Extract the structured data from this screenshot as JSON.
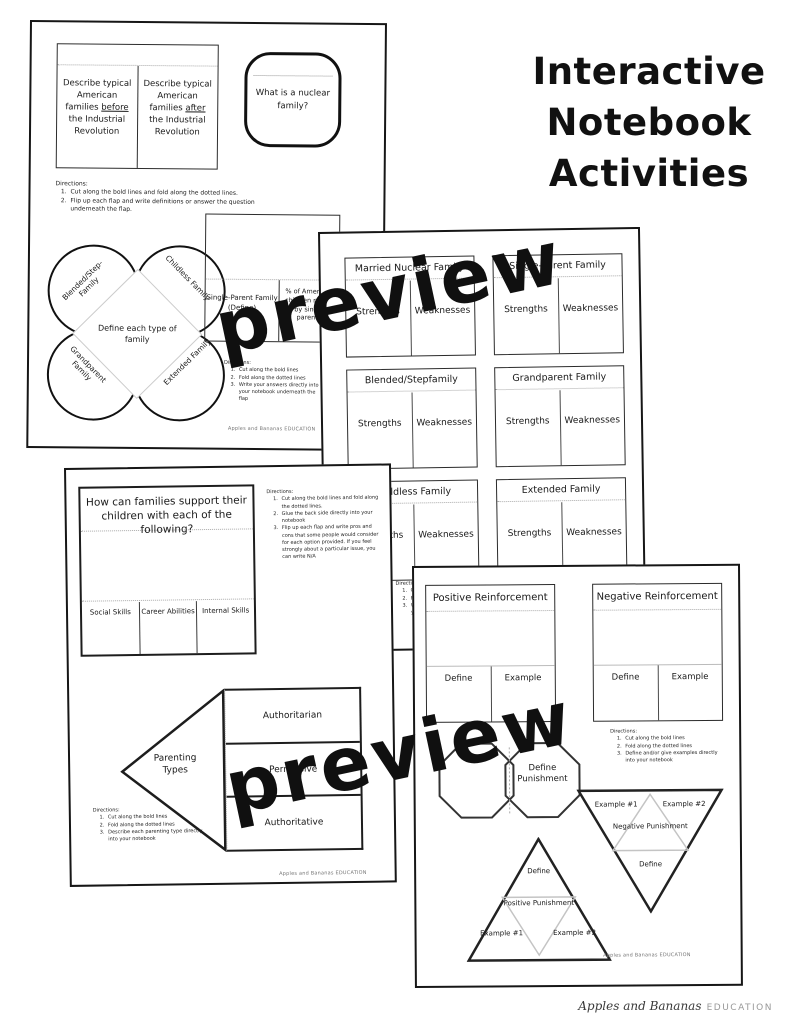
{
  "title": {
    "line1": "Interactive",
    "line2": "Notebook",
    "line3": "Activities"
  },
  "watermark": "preview",
  "brand": {
    "script": "Apples and Bananas",
    "caps": "EDUCATION"
  },
  "page_footer": "Apples and Bananas EDUCATION",
  "colors": {
    "ink": "#111111",
    "fold_dotted": "#aaaaaa",
    "light_gray": "#cccccc"
  },
  "page1": {
    "flap_left": {
      "pre": "Describe typical American families ",
      "u": "before",
      "post": " the Industrial Revolution"
    },
    "flap_right": {
      "pre": "Describe typical American families ",
      "u": "after",
      "post": " the Industrial Revolution"
    },
    "nuclear_question": "What is a nuclear family?",
    "directions_top": {
      "heading": "Directions:",
      "items": [
        "Cut along the bold lines and fold along the dotted lines.",
        "Flip up each flap and write definitions or answer the question underneath the flap."
      ]
    },
    "petals": {
      "top_left": "Blended/Step-Family",
      "top_right": "Childless Family",
      "bottom_left": "Grandparent Family",
      "bottom_right": "Extended Family",
      "center": "Define each type of family"
    },
    "single_parent_label": "Single-Parent Family (Define)",
    "percent_label": "% of American children raised by single parents",
    "directions_bottom": {
      "heading": "Directions:",
      "items": [
        "Cut along the bold lines",
        "Fold along the dotted lines",
        "Write your answers directly into your notebook underneath the flap"
      ]
    }
  },
  "page2": {
    "cards": [
      {
        "title": "Married Nuclear Family",
        "left": "Strengths",
        "right": "Weaknesses"
      },
      {
        "title": "Single-Parent Family",
        "left": "Strengths",
        "right": "Weaknesses"
      },
      {
        "title": "Blended/Stepfamily",
        "left": "Strengths",
        "right": "Weaknesses"
      },
      {
        "title": "Grandparent Family",
        "left": "Strengths",
        "right": "Weaknesses"
      },
      {
        "title": "Childless Family",
        "left": "Strengths",
        "right": "Weaknesses"
      },
      {
        "title": "Extended Family",
        "left": "Strengths",
        "right": "Weaknesses"
      }
    ],
    "directions": {
      "heading": "Directions:",
      "items": [
        "Cut along the bold lines",
        "Fold along the dotted lines",
        "Write your answers directly into your notebook"
      ]
    }
  },
  "page3": {
    "support_title": "How can families support their children with each of the following?",
    "columns": [
      "Social Skills",
      "Career Abilities",
      "Internal Skills"
    ],
    "directions_top": {
      "heading": "Directions:",
      "items": [
        "Cut along the bold lines and fold along the dotted lines.",
        "Glue the back side directly into your notebook",
        "Flip up each flap and write pros and cons that some people would consider for each option provided. If you feel strongly about a particular issue, you can write N/A"
      ]
    },
    "parenting": {
      "label": "Parenting Types",
      "flaps": [
        "Authoritarian",
        "Permissive",
        "Authoritative"
      ]
    },
    "directions_bottom": {
      "heading": "Directions:",
      "items": [
        "Cut along the bold lines",
        "Fold along the dotted lines",
        "Describe each parenting type directly into your notebook"
      ]
    }
  },
  "page4": {
    "cards": [
      {
        "title": "Positive Reinforcement",
        "left": "Define",
        "right": "Example"
      },
      {
        "title": "Negative Reinforcement",
        "left": "Define",
        "right": "Example"
      }
    ],
    "directions": {
      "heading": "Directions:",
      "items": [
        "Cut along the bold lines",
        "Fold along the dotted lines",
        "Define and/or give examples directly into your notebook"
      ]
    },
    "octagon_label": "Define Punishment",
    "negative_triangle": {
      "top_left": "Example #1",
      "top_right": "Example #2",
      "center": "Negative Punishment",
      "bottom": "Define"
    },
    "positive_triangle": {
      "top": "Define",
      "center": "Positive Punishment",
      "bottom_left": "Example #1",
      "bottom_right": "Example #2"
    }
  }
}
